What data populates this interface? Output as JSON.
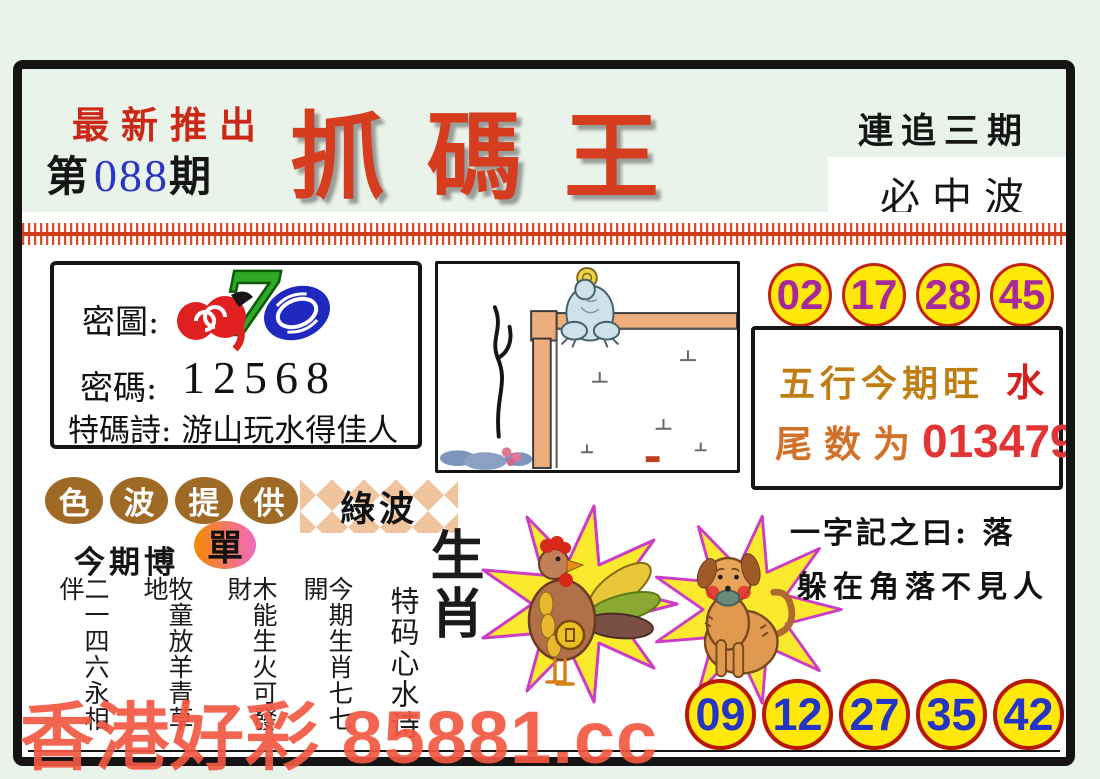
{
  "header": {
    "promo": "最新推出",
    "issue_prefix": "第",
    "issue_number": "088",
    "issue_suffix": "期",
    "title": "抓碼王",
    "chase_line": "連追三期",
    "hit_line": "必中波"
  },
  "secret_box": {
    "map_label": "密圖:",
    "code_label": "密碼:",
    "code_value": "12568",
    "poem_label": "特碼詩:",
    "poem_value": "游山玩水得佳人"
  },
  "top_numbers": [
    "02",
    "17",
    "28",
    "45"
  ],
  "info_box": {
    "wuxing_label": "五行今期旺",
    "wuxing_value": "水",
    "tail_label": "尾数为",
    "tail_value": "013479"
  },
  "color_wave": {
    "oval_chars": [
      "色",
      "波",
      "提",
      "供"
    ],
    "wave_value": "綠波"
  },
  "bet": {
    "label": "今期博",
    "value": "單"
  },
  "zodiac_heading": "生肖",
  "zodiac_poem": {
    "title": "特码心水诗",
    "lines": [
      "今期生肖七七開",
      "木能生火可發財",
      "牧童放羊青草地",
      "二一四六永相伴"
    ]
  },
  "riddle": {
    "line1": "一字記之曰: 落",
    "line2": "躲在角落不見人"
  },
  "bottom_numbers": [
    "09",
    "12",
    "27",
    "35",
    "42"
  ],
  "watermark": "香港好彩 85881.cc",
  "illustrations": {
    "secret_picture": "cherries-seven-zero",
    "center_picture": "frog-on-pipe",
    "zodiac_left": "rooster",
    "zodiac_right": "dog"
  },
  "colors": {
    "accent_red": "#d63c1e",
    "circle_yellow": "#ffe80a",
    "circle_border_red": "#c32410",
    "top_number_purple": "#a82a9a",
    "bottom_number_blue": "#2435c5",
    "gold": "#bf7d12",
    "oval_brown": "#9e6a26",
    "watermark_red": "#f25842",
    "background_mint": "#e9f3e9"
  }
}
